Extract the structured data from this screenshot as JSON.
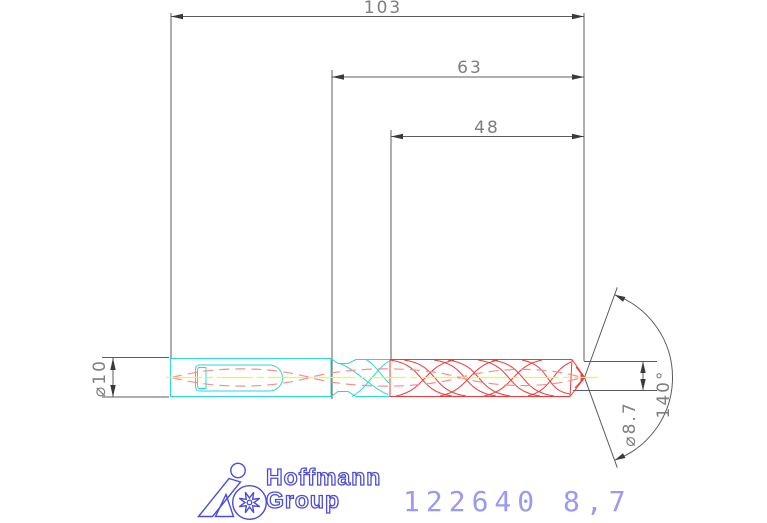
{
  "dimensions": {
    "overall_length": "103",
    "flute_length": "63",
    "cutting_length": "48",
    "shank_diameter": "⌀10",
    "cutting_diameter": "⌀8.7",
    "point_angle": "140°"
  },
  "branding": {
    "line1": "Hoffmann",
    "line2": "Group"
  },
  "part": {
    "number": "122640 8,7"
  },
  "colors": {
    "dimension_lines": "#5c5c5c",
    "dimension_text": "#7e7e7e",
    "shank_outline": "#2bd8d8",
    "flute_outline": "#ef3b3b",
    "coolant_hidden_lines": "#f2908e",
    "centerline": "#f8f820",
    "logo_blue": "#4d4dd9",
    "part_number_blue": "#9a9af0",
    "background": "#ffffff"
  }
}
